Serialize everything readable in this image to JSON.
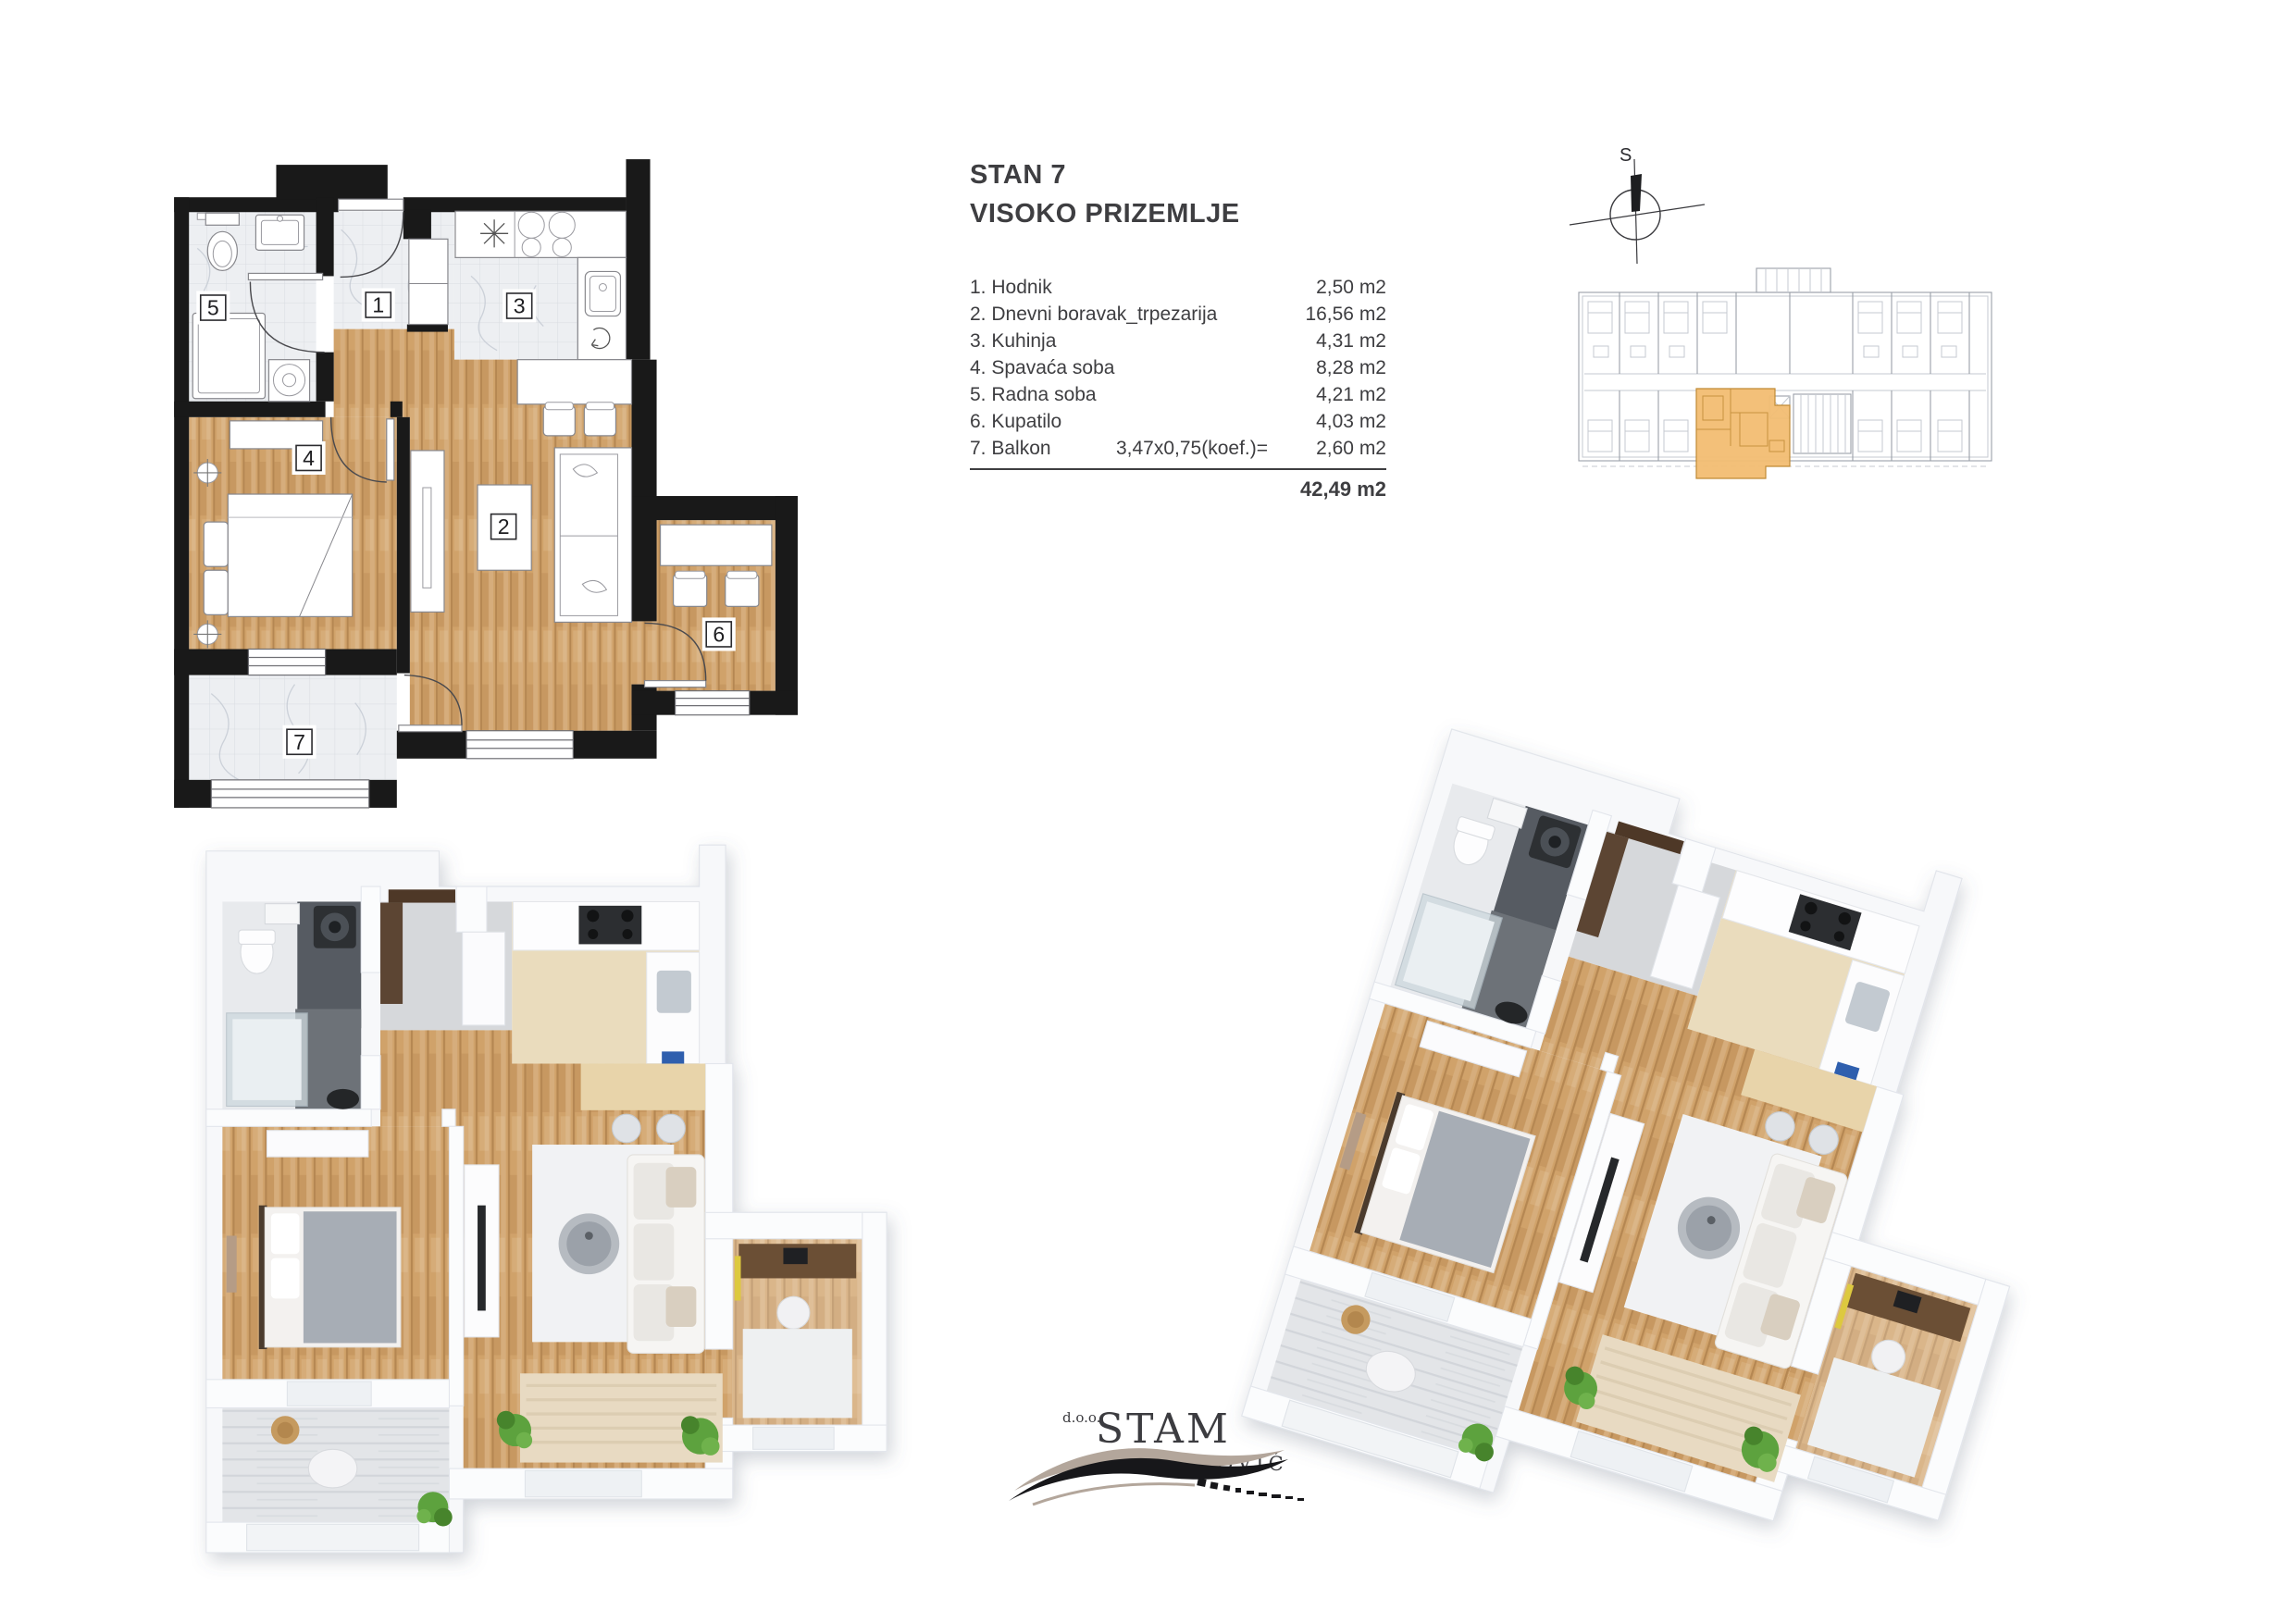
{
  "info": {
    "title1": "STAN 7",
    "title2": "VISOKO PRIZEMLJE",
    "rooms": [
      {
        "label": "1. Hodnik",
        "dim": "",
        "area": "2,50 m2"
      },
      {
        "label": "2. Dnevni boravak_trpezarija",
        "dim": "",
        "area": "16,56 m2"
      },
      {
        "label": "3. Kuhinja",
        "dim": "",
        "area": "4,31 m2"
      },
      {
        "label": "4. Spavaća soba",
        "dim": "",
        "area": "8,28 m2"
      },
      {
        "label": "5. Radna soba",
        "dim": "",
        "area": "4,21 m2"
      },
      {
        "label": "6. Kupatilo",
        "dim": "",
        "area": "4,03 m2"
      },
      {
        "label": "7. Balkon",
        "dim": "3,47x0,75(koef.)=",
        "area": "2,60 m2"
      }
    ],
    "total": "42,49 m2"
  },
  "plan2d": {
    "labels": [
      "1",
      "2",
      "3",
      "4",
      "5",
      "6",
      "7"
    ]
  },
  "compass": {
    "label": "S"
  },
  "logo": {
    "prefix": "d.o.o.",
    "name": "STAM",
    "surname": "PETROVIĆ"
  },
  "colors": {
    "text": "#3e3e41",
    "wall": "#191919",
    "wood": "#d0a26a",
    "wood-dark": "#b07f45",
    "tile": "#edeff2",
    "tile-line": "#d9dce1",
    "accent": "#f2bd72",
    "accent-stroke": "#c08a35",
    "plan-gray": "#9aa0a8",
    "logo-tan": "#b3a69b",
    "green": "#5da23e",
    "slate": "#565b62",
    "door-brown": "#4e3827"
  }
}
